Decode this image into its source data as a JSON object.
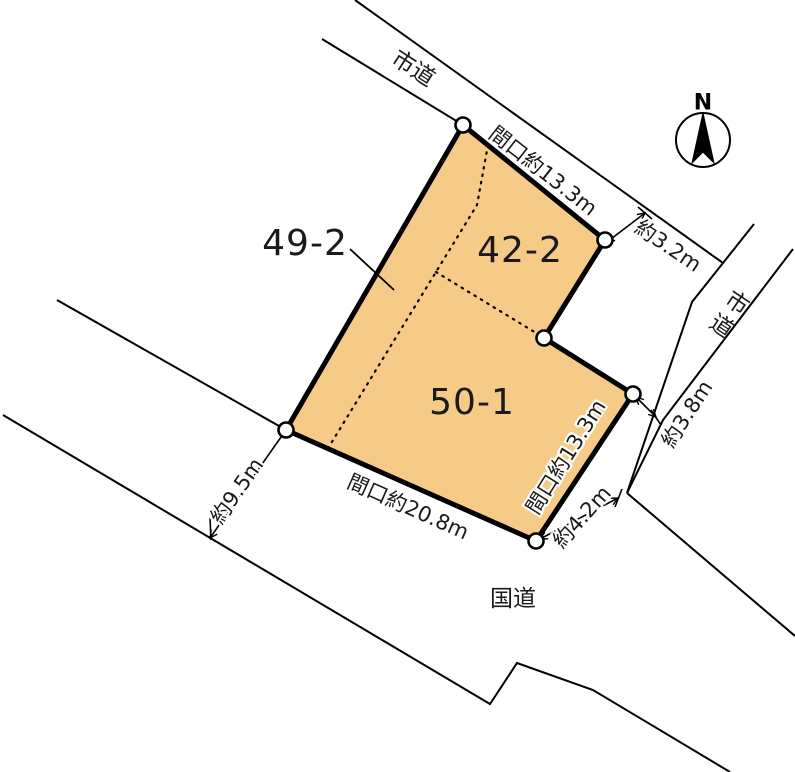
{
  "title": "区画図",
  "colors": {
    "parcel_fill": "#F6CB88",
    "line_color": "#000000",
    "background": "#FFFFFF"
  },
  "compass": {
    "north_label": "N"
  },
  "parcels": {
    "left": {
      "number": "49-2"
    },
    "upper": {
      "number": "42-2"
    },
    "lower": {
      "number": "50-1"
    }
  },
  "roads": {
    "top": {
      "name": "市道"
    },
    "right": {
      "name": "市道"
    },
    "bottom": {
      "name": "国道"
    }
  },
  "measurements": {
    "top_frontage": "間口約13.3m",
    "top_road_width": "約3.2m",
    "right_road_width": "約3.8m",
    "right_frontage": "間口約13.3m",
    "bottom_opening_width": "約4.2m",
    "bottom_frontage": "間口約20.8m",
    "left_road_width": "約9.5m"
  }
}
